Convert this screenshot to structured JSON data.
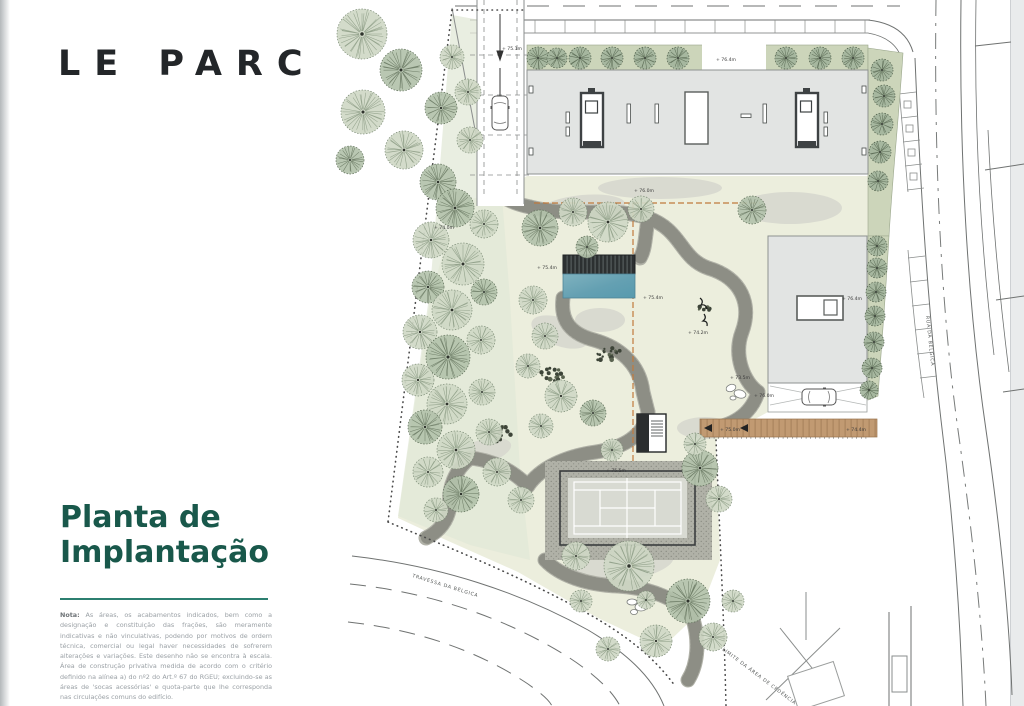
{
  "brand": {
    "logo": "LE PARC"
  },
  "panel": {
    "title": {
      "line1": "Planta de",
      "line2": "Implantação"
    },
    "note": {
      "label": "Nota:",
      "text": " As áreas, os acabamentos indicados, bem como a designação e constituição das frações, são meramente indicativas e não vinculativas, podendo por motivos de ordem técnica, comercial ou legal haver necessidades de sofrerem alterações e variações. Este desenho não se encontra à escala. Área de construção privativa medida de acordo com o critério definido na alínea a) do nº2 do Art.º 67 do RGEU; excluindo-se as áreas de 'socas acessórias' e quota-parte que lhe corresponda nas circulações comuns do edifício."
    }
  },
  "plan": {
    "streets": {
      "right": "RUA DA BÉLGICA",
      "bottom": "TRAVESSA DA BÉLGICA",
      "boundary": "LIMITE DA ÁREA DE CEDÊNCIA"
    },
    "markers": [
      {
        "text": "+ 76.4m",
        "x": 716,
        "y": 61
      },
      {
        "text": "+ 76.0m",
        "x": 634,
        "y": 192
      },
      {
        "text": "+ 76.4m",
        "x": 842,
        "y": 300
      },
      {
        "text": "+ 75.4m",
        "x": 537,
        "y": 269
      },
      {
        "text": "+ 75.4m",
        "x": 643,
        "y": 299
      },
      {
        "text": "+ 74.2m",
        "x": 688,
        "y": 334
      },
      {
        "text": "+ 74.0m",
        "x": 434,
        "y": 229
      },
      {
        "text": "+ 76.0m",
        "x": 754,
        "y": 397
      },
      {
        "text": "+ 75.0m",
        "x": 720,
        "y": 431
      },
      {
        "text": "+ 74.4m",
        "x": 846,
        "y": 431
      },
      {
        "text": "+ 75.5m",
        "x": 606,
        "y": 472
      },
      {
        "text": "+ 73.5m",
        "x": 730,
        "y": 379
      },
      {
        "text": "+ 75.1m",
        "x": 502,
        "y": 50
      }
    ]
  },
  "colors": {
    "accent_teal": "#19584b",
    "verge_green": "#ccd5ba",
    "pool_blue": "#69a4b6",
    "podium_orange": "#c07a3d"
  }
}
